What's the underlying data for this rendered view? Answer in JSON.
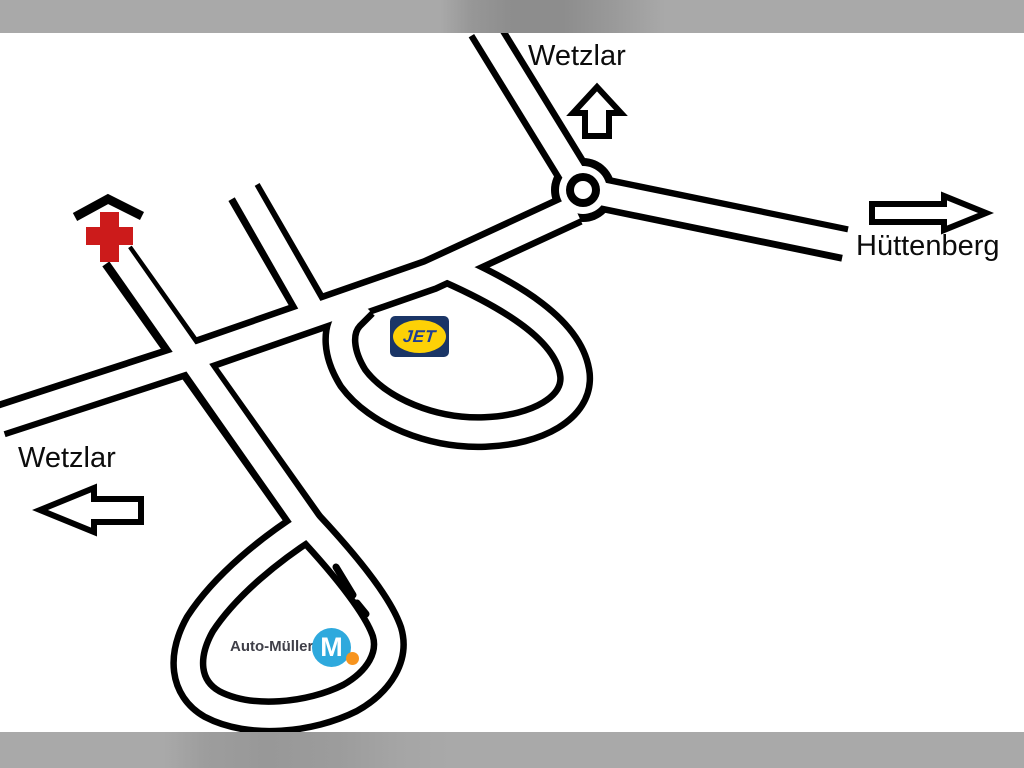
{
  "labels": {
    "top_destination": "Wetzlar",
    "right_destination": "Hüttenberg",
    "left_destination": "Wetzlar"
  },
  "logos": {
    "jet": {
      "text": "JET"
    },
    "auto_mueller": {
      "text": "Auto-Müller",
      "monogram": "M"
    }
  },
  "icons": {
    "up_arrow": "direction toward Wetzlar (north)",
    "right_arrow": "direction toward Hüttenberg (east)",
    "left_arrow": "direction toward Wetzlar (west)",
    "red_cross": "medical / hospital marker with roof",
    "roundabout": "three-exit roundabout"
  },
  "colors": {
    "road_line": "#000000",
    "background": "#ffffff",
    "border_band": "#a9a9a9",
    "red_cross": "#cc1b1b",
    "jet_navy": "#1a3566",
    "jet_yellow": "#fdd106",
    "jet_text": "#1e3e96",
    "mueller_blue": "#2ea9dd",
    "mueller_orange": "#f7941e",
    "mueller_text": "#3f3f48"
  }
}
